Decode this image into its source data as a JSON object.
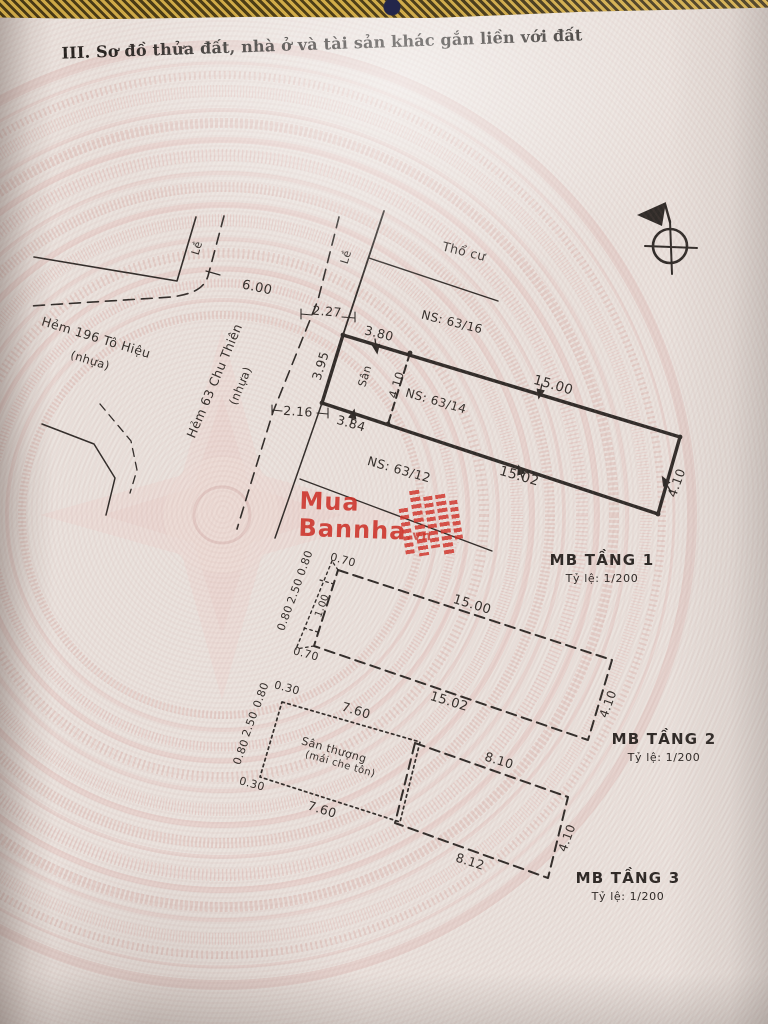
{
  "page": {
    "title": "III. Sơ đồ thửa đất, nhà ở và tài sản khác gắn liền với đất"
  },
  "watermark": {
    "line1": "Mua",
    "line2": "Bannha",
    "suffix": ".vn",
    "icon": "building-blocks-icon",
    "color": "#ce2d24"
  },
  "compass": {
    "icon": "north-arrow-compass"
  },
  "floors": [
    {
      "name": "MB TẦNG 1",
      "scale": "Tỷ lệ:  1/200"
    },
    {
      "name": "MB TẦNG 2",
      "scale": "Tỷ lệ:  1/200"
    },
    {
      "name": "MB TẦNG 3",
      "scale": "Tỷ lệ:  1/200"
    }
  ],
  "labels": [
    {
      "n": "curb-label",
      "t": "Lề",
      "x": 197,
      "y": 248,
      "r": -73,
      "s": 11
    },
    {
      "n": "curb-label",
      "t": "Lề",
      "x": 346,
      "y": 257,
      "r": -73,
      "s": 11
    },
    {
      "n": "dim-alley-width",
      "t": "6.00",
      "x": 257,
      "y": 288,
      "r": 12,
      "s": 13
    },
    {
      "n": "dim-curb-width",
      "t": "2.27",
      "x": 327,
      "y": 312,
      "r": 5,
      "s": 12.5
    },
    {
      "n": "street-name",
      "t": "Hẻm 196 Tô Hiệu",
      "x": 96,
      "y": 338,
      "r": 17,
      "s": 12.5
    },
    {
      "n": "street-surface",
      "t": "(nhựa)",
      "x": 90,
      "y": 361,
      "r": 17,
      "s": 11.5
    },
    {
      "n": "street-name",
      "t": "Hẻm 63 Chu Thiên",
      "x": 215,
      "y": 381,
      "r": -67,
      "s": 12.5
    },
    {
      "n": "street-surface",
      "t": "(nhựa)",
      "x": 241,
      "y": 386,
      "r": -67,
      "s": 11.5
    },
    {
      "n": "land-type-label",
      "t": "Thổ cư",
      "x": 464,
      "y": 252,
      "r": 14,
      "s": 12.5
    },
    {
      "n": "neighbor-label",
      "t": "NS: 63/16",
      "x": 452,
      "y": 322,
      "r": 14,
      "s": 12
    },
    {
      "n": "dim",
      "t": "3.80",
      "x": 379,
      "y": 334,
      "r": 14,
      "s": 12.5
    },
    {
      "n": "dim",
      "t": "3.95",
      "x": 321,
      "y": 366,
      "r": -73,
      "s": 12.5
    },
    {
      "n": "yard-label",
      "t": "Sân",
      "x": 365,
      "y": 376,
      "r": -73,
      "s": 11
    },
    {
      "n": "dim",
      "t": "4.10",
      "x": 397,
      "y": 385,
      "r": -73,
      "s": 11.5
    },
    {
      "n": "neighbor-label",
      "t": "NS: 63/14",
      "x": 436,
      "y": 401,
      "r": 16,
      "s": 12
    },
    {
      "n": "dim",
      "t": "15.00",
      "x": 553,
      "y": 386,
      "r": 16,
      "s": 13.5
    },
    {
      "n": "dim",
      "t": "3.84",
      "x": 351,
      "y": 424,
      "r": 16,
      "s": 12.5
    },
    {
      "n": "dim",
      "t": "2.16",
      "x": 298,
      "y": 412,
      "r": 4,
      "s": 12.5
    },
    {
      "n": "neighbor-label",
      "t": "NS: 63/12",
      "x": 399,
      "y": 470,
      "r": 16,
      "s": 12.5
    },
    {
      "n": "dim",
      "t": "15.02",
      "x": 519,
      "y": 477,
      "r": 16,
      "s": 13.5
    },
    {
      "n": "dim",
      "t": "4.10",
      "x": 677,
      "y": 483,
      "r": -70,
      "s": 12.5
    },
    {
      "n": "dim",
      "t": "0.70",
      "x": 343,
      "y": 560,
      "r": 15,
      "s": 11
    },
    {
      "n": "dim",
      "t": "0.80",
      "x": 305,
      "y": 563,
      "r": -70,
      "s": 11
    },
    {
      "n": "dim",
      "t": "2.50",
      "x": 295,
      "y": 591,
      "r": -70,
      "s": 11
    },
    {
      "n": "dim",
      "t": "0.80",
      "x": 285,
      "y": 618,
      "r": -70,
      "s": 11
    },
    {
      "n": "dim",
      "t": "1.00",
      "x": 323,
      "y": 606,
      "r": -70,
      "s": 10
    },
    {
      "n": "dim",
      "t": "0.70",
      "x": 306,
      "y": 654,
      "r": 15,
      "s": 11
    },
    {
      "n": "dim",
      "t": "15.00",
      "x": 472,
      "y": 605,
      "r": 17,
      "s": 13
    },
    {
      "n": "dim",
      "t": "15.02",
      "x": 449,
      "y": 702,
      "r": 17,
      "s": 13
    },
    {
      "n": "dim",
      "t": "4.10",
      "x": 608,
      "y": 704,
      "r": -70,
      "s": 12
    },
    {
      "n": "dim",
      "t": "0.30",
      "x": 287,
      "y": 688,
      "r": 15,
      "s": 11
    },
    {
      "n": "dim",
      "t": "0.80",
      "x": 261,
      "y": 695,
      "r": -70,
      "s": 11
    },
    {
      "n": "dim",
      "t": "2.50",
      "x": 250,
      "y": 724,
      "r": -70,
      "s": 11
    },
    {
      "n": "dim",
      "t": "0.80",
      "x": 241,
      "y": 752,
      "r": -70,
      "s": 11
    },
    {
      "n": "dim",
      "t": "0.30",
      "x": 252,
      "y": 784,
      "r": 15,
      "s": 11
    },
    {
      "n": "dim",
      "t": "7.60",
      "x": 356,
      "y": 711,
      "r": 17,
      "s": 12.5
    },
    {
      "n": "terrace-label",
      "t": "Sân thượng",
      "x": 334,
      "y": 750,
      "r": 16,
      "s": 11
    },
    {
      "n": "terrace-label",
      "t": "(mái che tôn)",
      "x": 340,
      "y": 765,
      "r": 16,
      "s": 10
    },
    {
      "n": "dim",
      "t": "7.60",
      "x": 322,
      "y": 810,
      "r": 17,
      "s": 12.5
    },
    {
      "n": "dim",
      "t": "8.10",
      "x": 499,
      "y": 761,
      "r": 17,
      "s": 12.5
    },
    {
      "n": "dim",
      "t": "8.12",
      "x": 470,
      "y": 862,
      "r": 17,
      "s": 12.5
    },
    {
      "n": "dim",
      "t": "4.10",
      "x": 567,
      "y": 838,
      "r": -70,
      "s": 12
    }
  ]
}
